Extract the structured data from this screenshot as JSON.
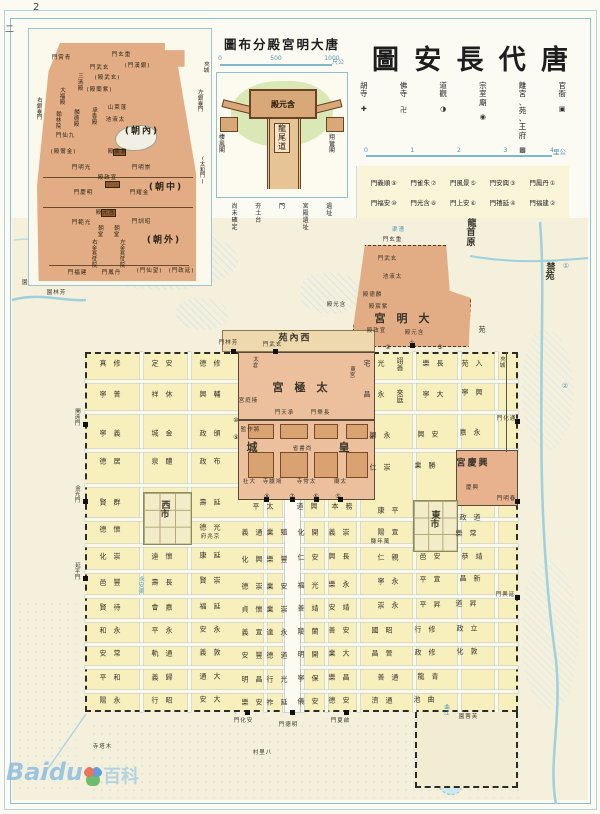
{
  "page": {
    "number": "2",
    "side_mark": "二",
    "right_margin_marks": [
      {
        "t": "①",
        "x": 566,
        "y": 266
      },
      {
        "t": "②",
        "x": 565,
        "y": 386
      }
    ]
  },
  "watermark": {
    "brand": "Baidu",
    "suffix": "百科"
  },
  "header": {
    "title_chars": [
      "圖",
      "安",
      "長",
      "代",
      "唐"
    ],
    "legend": [
      {
        "label": "胡寺",
        "symbol": "✚"
      },
      {
        "label": "佛寺",
        "symbol": "卍"
      },
      {
        "label": "道觀",
        "symbol": "◑"
      },
      {
        "label": "宗室廟",
        "symbol": "◉"
      },
      {
        "label": "離宮、苑、王府",
        "symbol": "▩"
      },
      {
        "label": "官衙",
        "symbol": "▣"
      }
    ],
    "scale": {
      "ticks": [
        "0",
        "1",
        "2",
        "3",
        "4"
      ],
      "unit": "里公"
    },
    "gates_row1": [
      {
        "name": "門義順",
        "num": "⑨"
      },
      {
        "name": "門雀朱",
        "num": "⑦"
      },
      {
        "name": "門風景",
        "num": "⑤"
      },
      {
        "name": "門安興",
        "num": "③"
      },
      {
        "name": "門鳳丹",
        "num": "①"
      }
    ],
    "gates_row2": [
      {
        "name": "門福安",
        "num": "⑩"
      },
      {
        "name": "門光含",
        "num": "⑧"
      },
      {
        "name": "門上安",
        "num": "⑥"
      },
      {
        "name": "門禧延",
        "num": "④"
      },
      {
        "name": "門福建",
        "num": "②"
      }
    ]
  },
  "inset_daming": {
    "labels": [
      {
        "t": "門霄青",
        "x": 32,
        "y": 30,
        "cls": "tiny"
      },
      {
        "t": "門玄重",
        "x": 92,
        "y": 27,
        "cls": "tiny"
      },
      {
        "t": "三清殿",
        "x": 52,
        "y": 46,
        "v": 1,
        "cls": "tiny"
      },
      {
        "t": "門武玄",
        "x": 70,
        "y": 40,
        "cls": "tiny"
      },
      {
        "t": "(門漢銀)",
        "x": 108,
        "y": 38,
        "cls": "tiny"
      },
      {
        "t": "大福殿",
        "x": 34,
        "y": 60,
        "v": 1,
        "cls": "tiny"
      },
      {
        "t": "(殿武玄)",
        "x": 78,
        "y": 50,
        "cls": "tiny"
      },
      {
        "t": "(殿蘭紫)",
        "x": 70,
        "y": 62,
        "cls": "tiny"
      },
      {
        "t": "翰林院",
        "x": 30,
        "y": 84,
        "v": 1,
        "cls": "tiny"
      },
      {
        "t": "麟德殿",
        "x": 48,
        "y": 82,
        "v": 1,
        "cls": "tiny"
      },
      {
        "t": "承香殿",
        "x": 66,
        "y": 80,
        "v": 1,
        "cls": "tiny"
      },
      {
        "t": "山萊蓬",
        "x": 88,
        "y": 80,
        "cls": "tiny"
      },
      {
        "t": "池液太",
        "x": 86,
        "y": 92,
        "cls": "tiny"
      },
      {
        "t": "(朝內)",
        "x": 112,
        "y": 103,
        "cls": "big2"
      },
      {
        "t": "門仙九",
        "x": 36,
        "y": 108,
        "cls": "tiny"
      },
      {
        "t": "(殿鸞金)",
        "x": 34,
        "y": 124,
        "cls": "tiny"
      },
      {
        "t": "殿宸紫",
        "x": 88,
        "y": 124,
        "cls": "tiny"
      },
      {
        "t": "門明光",
        "x": 52,
        "y": 140,
        "cls": "tiny"
      },
      {
        "t": "門明崇",
        "x": 112,
        "y": 140,
        "cls": "tiny"
      },
      {
        "t": "殿政宣",
        "x": 78,
        "y": 150,
        "cls": "tiny"
      },
      {
        "t": "(朝中)",
        "x": 136,
        "y": 159,
        "cls": "big2"
      },
      {
        "t": "門慶明",
        "x": 54,
        "y": 165,
        "cls": "tiny"
      },
      {
        "t": "門耀金",
        "x": 110,
        "y": 165,
        "cls": "tiny"
      },
      {
        "t": "殿元含",
        "x": 76,
        "y": 185,
        "cls": "tiny"
      },
      {
        "t": "門範光",
        "x": 52,
        "y": 195,
        "cls": "tiny"
      },
      {
        "t": "門訓昭",
        "x": 112,
        "y": 194,
        "cls": "tiny"
      },
      {
        "t": "朝堂",
        "x": 72,
        "y": 198,
        "v": 1,
        "cls": "tiny"
      },
      {
        "t": "朝堂",
        "x": 88,
        "y": 198,
        "v": 1,
        "cls": "tiny"
      },
      {
        "t": "(朝外)",
        "x": 134,
        "y": 212,
        "cls": "big2"
      },
      {
        "t": "右金吾仗院",
        "x": 66,
        "y": 212,
        "v": 1,
        "cls": "tiny"
      },
      {
        "t": "左金吾仗院",
        "x": 94,
        "y": 212,
        "v": 1,
        "cls": "tiny"
      },
      {
        "t": "門福建",
        "x": 48,
        "y": 245,
        "cls": "tiny"
      },
      {
        "t": "門鳳丹",
        "x": 82,
        "y": 245,
        "cls": "tiny"
      },
      {
        "t": "(門仙望)",
        "x": 120,
        "y": 243,
        "cls": "tiny"
      },
      {
        "t": "(門政延)",
        "x": 152,
        "y": 243,
        "cls": "tiny"
      },
      {
        "t": "右銀臺門",
        "x": 11,
        "y": 70,
        "v": 1,
        "cls": "tiny"
      },
      {
        "t": "左銀臺門",
        "x": 172,
        "y": 62,
        "v": 1,
        "cls": "tiny"
      },
      {
        "t": "夾城",
        "x": 178,
        "y": 34,
        "v": 1,
        "cls": "tiny"
      },
      {
        "t": "(太和門)",
        "x": 174,
        "y": 128,
        "v": 1,
        "cls": "tiny"
      }
    ]
  },
  "inset_hanyuan": {
    "title": "圖布分殿宮明大唐",
    "scale": {
      "ticks": [
        "0",
        "500",
        "1000"
      ],
      "unit": "尺公"
    },
    "hall_label": "殿元含",
    "ramp_label": "龍尾道",
    "left_pavilion": "棲鳳閣",
    "right_pavilion": "翔鸞閣",
    "legend": [
      "尚未確定",
      "夯土台",
      "門",
      "宮殿遺址",
      "遺址"
    ]
  },
  "map": {
    "region_labels": [
      {
        "t": "龍首原",
        "x": 472,
        "y": 220,
        "v": 1,
        "cls": "big2"
      },
      {
        "t": "禁苑",
        "x": 551,
        "y": 264,
        "v": 1,
        "cls": "big2"
      },
      {
        "t": "苑",
        "x": 482,
        "y": 330
      },
      {
        "t": "園梨",
        "x": 28,
        "y": 284,
        "cls": "tiny"
      },
      {
        "t": "園林芳",
        "x": 56,
        "y": 294,
        "cls": "tiny"
      },
      {
        "t": "渠漕",
        "x": 398,
        "y": 231,
        "cls": "tiny blue"
      },
      {
        "t": "夾城",
        "x": 503,
        "y": 358,
        "v": 1,
        "cls": "tiny"
      },
      {
        "t": "門玄重",
        "x": 392,
        "y": 241,
        "cls": "tiny"
      },
      {
        "t": "門武玄",
        "x": 387,
        "y": 260,
        "cls": "tiny"
      },
      {
        "t": "池液太",
        "x": 392,
        "y": 278,
        "cls": "tiny"
      },
      {
        "t": "殿德麟",
        "x": 372,
        "y": 296,
        "cls": "tiny"
      },
      {
        "t": "殿宸紫",
        "x": 378,
        "y": 308,
        "cls": "tiny"
      },
      {
        "t": "宮明大",
        "x": 402,
        "y": 319,
        "cls": "big"
      },
      {
        "t": "殿政宣",
        "x": 376,
        "y": 332,
        "cls": "tiny"
      },
      {
        "t": "殿元含",
        "x": 414,
        "y": 334,
        "cls": "tiny"
      },
      {
        "t": "殿光含",
        "x": 336,
        "y": 306,
        "cls": "tiny"
      },
      {
        "t": "苑內西",
        "x": 294,
        "y": 339,
        "cls": "big2"
      },
      {
        "t": "門林芳",
        "x": 228,
        "y": 344,
        "cls": "tiny"
      },
      {
        "t": "門武玄",
        "x": 272,
        "y": 346,
        "cls": "tiny"
      },
      {
        "t": "太倉",
        "x": 256,
        "y": 358,
        "v": 1,
        "cls": "tiny"
      },
      {
        "t": "宮極太",
        "x": 300,
        "y": 388,
        "cls": "big"
      },
      {
        "t": "東宮",
        "x": 353,
        "y": 368,
        "v": 1,
        "cls": "tiny"
      },
      {
        "t": "宮庭掖",
        "x": 248,
        "y": 402,
        "cls": "tiny"
      },
      {
        "t": "門天承",
        "x": 284,
        "y": 414,
        "cls": "tiny"
      },
      {
        "t": "門樂長",
        "x": 320,
        "y": 414,
        "cls": "tiny"
      },
      {
        "t": "監作將",
        "x": 250,
        "y": 431,
        "cls": "tiny"
      },
      {
        "t": "城",
        "x": 252,
        "y": 448,
        "cls": "big"
      },
      {
        "t": "皇",
        "x": 344,
        "y": 448,
        "cls": "big"
      },
      {
        "t": "省書尚",
        "x": 302,
        "y": 450,
        "cls": "tiny"
      },
      {
        "t": "社大",
        "x": 249,
        "y": 483,
        "cls": "tiny"
      },
      {
        "t": "寺臚鴻",
        "x": 272,
        "y": 483,
        "cls": "tiny"
      },
      {
        "t": "寺常太",
        "x": 306,
        "y": 483,
        "cls": "tiny"
      },
      {
        "t": "廟太",
        "x": 340,
        "y": 483,
        "cls": "tiny"
      },
      {
        "t": "宮慶興",
        "x": 472,
        "y": 464,
        "cls": "big2"
      },
      {
        "t": "慶興",
        "x": 472,
        "y": 489,
        "cls": "tiny"
      },
      {
        "t": "西市",
        "x": 166,
        "y": 502,
        "v": 1,
        "cls": "big2"
      },
      {
        "t": "東市",
        "x": 436,
        "y": 512,
        "v": 1,
        "cls": "big2"
      },
      {
        "t": "府兆京",
        "x": 210,
        "y": 538,
        "cls": "tiny"
      },
      {
        "t": "縣年萬",
        "x": 380,
        "y": 543,
        "cls": "tiny"
      },
      {
        "t": "永安渠",
        "x": 142,
        "y": 578,
        "v": 1,
        "cls": "tiny blue"
      },
      {
        "t": "曲江",
        "x": 447,
        "y": 706,
        "v": 1,
        "cls": "tiny blue"
      },
      {
        "t": "園蓉芙",
        "x": 468,
        "y": 718,
        "cls": "tiny"
      },
      {
        "t": "寺塔木",
        "x": 102,
        "y": 748,
        "cls": "tiny"
      },
      {
        "t": "村里八",
        "x": 262,
        "y": 754,
        "cls": "tiny"
      }
    ],
    "gate_labels": [
      {
        "t": "開遠門",
        "x": 78,
        "y": 410,
        "v": 1,
        "cls": "tiny"
      },
      {
        "t": "金光門",
        "x": 78,
        "y": 487,
        "v": 1,
        "cls": "tiny"
      },
      {
        "t": "延平門",
        "x": 78,
        "y": 564,
        "v": 1,
        "cls": "tiny"
      },
      {
        "t": "門化通",
        "x": 506,
        "y": 420,
        "cls": "tiny"
      },
      {
        "t": "門明春",
        "x": 506,
        "y": 500,
        "cls": "tiny"
      },
      {
        "t": "門興延",
        "x": 505,
        "y": 596,
        "cls": "tiny"
      },
      {
        "t": "門化安",
        "x": 243,
        "y": 722,
        "cls": "tiny"
      },
      {
        "t": "門德明",
        "x": 288,
        "y": 726,
        "cls": "tiny"
      },
      {
        "t": "門夏啟",
        "x": 340,
        "y": 722,
        "cls": "tiny"
      }
    ],
    "gate_markers": [
      {
        "t": "①",
        "x": 412,
        "y": 344
      },
      {
        "t": "②",
        "x": 388,
        "y": 348
      },
      {
        "t": "③",
        "x": 440,
        "y": 348
      },
      {
        "t": "④",
        "x": 372,
        "y": 438
      },
      {
        "t": "⑤",
        "x": 338,
        "y": 497
      },
      {
        "t": "⑥",
        "x": 316,
        "y": 497
      },
      {
        "t": "⑦",
        "x": 292,
        "y": 497
      },
      {
        "t": "⑧",
        "x": 267,
        "y": 497
      },
      {
        "t": "⑨",
        "x": 236,
        "y": 438
      },
      {
        "t": "⑩",
        "x": 236,
        "y": 421
      }
    ],
    "ward_labels": [
      {
        "t": "真修",
        "x": 110,
        "y": 364
      },
      {
        "t": "定安",
        "x": 162,
        "y": 364
      },
      {
        "t": "德修",
        "x": 210,
        "y": 364
      },
      {
        "t": "寧普",
        "x": 110,
        "y": 395
      },
      {
        "t": "祥休",
        "x": 162,
        "y": 395
      },
      {
        "t": "興輔",
        "x": 210,
        "y": 395
      },
      {
        "t": "寧義",
        "x": 110,
        "y": 434
      },
      {
        "t": "城金",
        "x": 162,
        "y": 434
      },
      {
        "t": "政頒",
        "x": 210,
        "y": 434
      },
      {
        "t": "德居",
        "x": 110,
        "y": 462
      },
      {
        "t": "泉醴",
        "x": 162,
        "y": 462
      },
      {
        "t": "政布",
        "x": 210,
        "y": 462
      },
      {
        "t": "賢群",
        "x": 110,
        "y": 503
      },
      {
        "t": "壽延",
        "x": 210,
        "y": 503
      },
      {
        "t": "德懷",
        "x": 110,
        "y": 530
      },
      {
        "t": "德光",
        "x": 210,
        "y": 528
      },
      {
        "t": "化崇",
        "x": 110,
        "y": 557
      },
      {
        "t": "遠懷",
        "x": 162,
        "y": 557
      },
      {
        "t": "康延",
        "x": 210,
        "y": 556
      },
      {
        "t": "邑豐",
        "x": 110,
        "y": 583
      },
      {
        "t": "壽長",
        "x": 162,
        "y": 583
      },
      {
        "t": "賢崇",
        "x": 210,
        "y": 581
      },
      {
        "t": "賢待",
        "x": 110,
        "y": 608
      },
      {
        "t": "會嘉",
        "x": 162,
        "y": 608
      },
      {
        "t": "福延",
        "x": 210,
        "y": 607
      },
      {
        "t": "和永",
        "x": 110,
        "y": 631
      },
      {
        "t": "平永",
        "x": 162,
        "y": 631
      },
      {
        "t": "安永",
        "x": 210,
        "y": 630
      },
      {
        "t": "安常",
        "x": 110,
        "y": 654
      },
      {
        "t": "軌通",
        "x": 162,
        "y": 654
      },
      {
        "t": "義敦",
        "x": 210,
        "y": 653
      },
      {
        "t": "平和",
        "x": 110,
        "y": 678
      },
      {
        "t": "義歸",
        "x": 162,
        "y": 678
      },
      {
        "t": "通大",
        "x": 210,
        "y": 677
      },
      {
        "t": "陽永",
        "x": 110,
        "y": 701
      },
      {
        "t": "行昭",
        "x": 162,
        "y": 701
      },
      {
        "t": "安大",
        "x": 210,
        "y": 700
      },
      {
        "t": "平太",
        "x": 263,
        "y": 507
      },
      {
        "t": "道興",
        "x": 307,
        "y": 507
      },
      {
        "t": "本務",
        "x": 342,
        "y": 507
      },
      {
        "t": "義通",
        "x": 252,
        "y": 533
      },
      {
        "t": "業殖",
        "x": 277,
        "y": 533
      },
      {
        "t": "化開",
        "x": 308,
        "y": 533
      },
      {
        "t": "義崇",
        "x": 339,
        "y": 533
      },
      {
        "t": "化興",
        "x": 252,
        "y": 560
      },
      {
        "t": "樂豐",
        "x": 277,
        "y": 560
      },
      {
        "t": "仁安",
        "x": 308,
        "y": 558
      },
      {
        "t": "興長",
        "x": 339,
        "y": 557
      },
      {
        "t": "德崇",
        "x": 252,
        "y": 587
      },
      {
        "t": "業安",
        "x": 277,
        "y": 587
      },
      {
        "t": "福光",
        "x": 308,
        "y": 586
      },
      {
        "t": "樂永",
        "x": 339,
        "y": 585
      },
      {
        "t": "貞懷",
        "x": 252,
        "y": 610
      },
      {
        "t": "業崇",
        "x": 277,
        "y": 610
      },
      {
        "t": "善靖",
        "x": 308,
        "y": 609
      },
      {
        "t": "安靖",
        "x": 339,
        "y": 608
      },
      {
        "t": "義宣",
        "x": 252,
        "y": 633
      },
      {
        "t": "達永",
        "x": 277,
        "y": 633
      },
      {
        "t": "陵蘭",
        "x": 308,
        "y": 632
      },
      {
        "t": "善安",
        "x": 339,
        "y": 631
      },
      {
        "t": "安豐",
        "x": 252,
        "y": 656
      },
      {
        "t": "德道",
        "x": 277,
        "y": 656
      },
      {
        "t": "明開",
        "x": 308,
        "y": 655
      },
      {
        "t": "業大",
        "x": 339,
        "y": 654
      },
      {
        "t": "明昌",
        "x": 252,
        "y": 680
      },
      {
        "t": "行光",
        "x": 277,
        "y": 680
      },
      {
        "t": "寧保",
        "x": 308,
        "y": 679
      },
      {
        "t": "樂昌",
        "x": 339,
        "y": 678
      },
      {
        "t": "樂安",
        "x": 252,
        "y": 703
      },
      {
        "t": "祚延",
        "x": 277,
        "y": 703
      },
      {
        "t": "儀安",
        "x": 308,
        "y": 702
      },
      {
        "t": "德安",
        "x": 339,
        "y": 701
      },
      {
        "t": "宅光",
        "x": 374,
        "y": 364
      },
      {
        "t": "翊善",
        "x": 400,
        "y": 358,
        "v": 1
      },
      {
        "t": "樂長",
        "x": 433,
        "y": 364
      },
      {
        "t": "苑入",
        "x": 472,
        "y": 364
      },
      {
        "t": "昌永",
        "x": 374,
        "y": 395
      },
      {
        "t": "來庭",
        "x": 400,
        "y": 390,
        "v": 1
      },
      {
        "t": "寧大",
        "x": 433,
        "y": 395
      },
      {
        "t": "寧興",
        "x": 472,
        "y": 393
      },
      {
        "t": "興永",
        "x": 380,
        "y": 436
      },
      {
        "t": "興安",
        "x": 428,
        "y": 435
      },
      {
        "t": "嘉永",
        "x": 470,
        "y": 433
      },
      {
        "t": "仁崇",
        "x": 380,
        "y": 468
      },
      {
        "t": "業勝",
        "x": 425,
        "y": 466
      },
      {
        "t": "康平",
        "x": 388,
        "y": 511
      },
      {
        "t": "政道",
        "x": 470,
        "y": 518
      },
      {
        "t": "陽宣",
        "x": 388,
        "y": 533
      },
      {
        "t": "樂常",
        "x": 466,
        "y": 534
      },
      {
        "t": "仁親",
        "x": 388,
        "y": 558
      },
      {
        "t": "邑安",
        "x": 430,
        "y": 557
      },
      {
        "t": "恭靖",
        "x": 472,
        "y": 557
      },
      {
        "t": "寧永",
        "x": 388,
        "y": 582
      },
      {
        "t": "平宣",
        "x": 430,
        "y": 580
      },
      {
        "t": "昌新",
        "x": 470,
        "y": 579
      },
      {
        "t": "崇永",
        "x": 388,
        "y": 606
      },
      {
        "t": "平昇",
        "x": 430,
        "y": 605
      },
      {
        "t": "道昇",
        "x": 466,
        "y": 604
      },
      {
        "t": "國昭",
        "x": 382,
        "y": 631
      },
      {
        "t": "行修",
        "x": 425,
        "y": 630
      },
      {
        "t": "政立",
        "x": 467,
        "y": 629
      },
      {
        "t": "昌晉",
        "x": 382,
        "y": 654
      },
      {
        "t": "政修",
        "x": 425,
        "y": 653
      },
      {
        "t": "化敦",
        "x": 467,
        "y": 652
      },
      {
        "t": "善通",
        "x": 388,
        "y": 678
      },
      {
        "t": "龍青",
        "x": 428,
        "y": 677
      },
      {
        "t": "濟通",
        "x": 382,
        "y": 701
      },
      {
        "t": "池曲",
        "x": 424,
        "y": 700
      }
    ]
  }
}
